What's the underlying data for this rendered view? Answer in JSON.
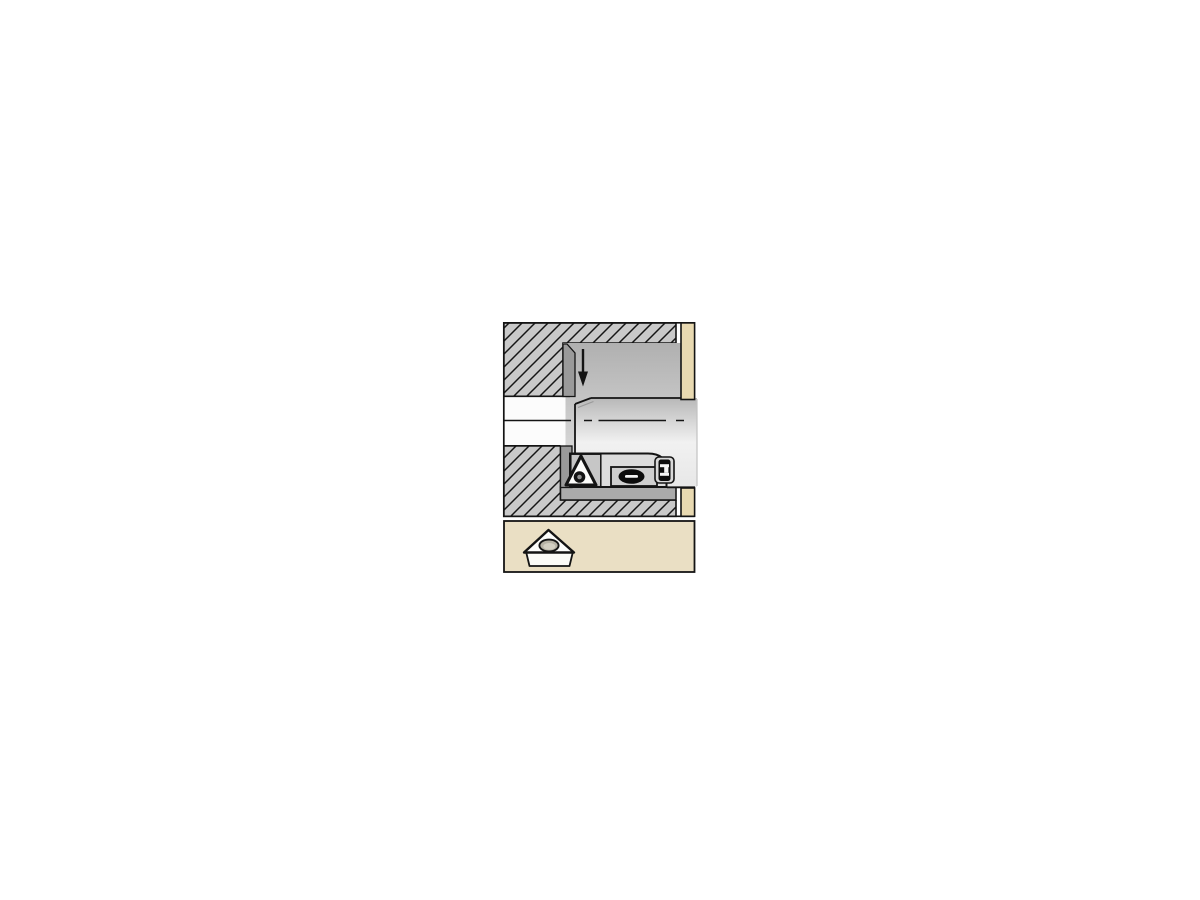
{
  "diagram": {
    "type": "machining-application-illustration",
    "subject": "boring-bar-with-cartridge-cutting-inside-counterbore",
    "icons": {
      "feed_arrow": "downward-feed-direction-arrow",
      "insert_main": "triangular-cutting-insert-with-hole",
      "insert_panel": "triangular-insert-3d-icon",
      "clamp_screw": "slotted-clamp-screw-top-view",
      "adjustment_screw": "side-view-adjustment-screw"
    },
    "colors": {
      "page_bg": "#ffffff",
      "outline": "#141414",
      "hatch_fill": "#c9c9c9",
      "bore_shadow": "#9a9a9a",
      "bore_grad_top": "#b0b0b0",
      "bore_grad_bottom": "#e9e9e9",
      "bar_grad_top": "#b8b8b8",
      "bar_grad_mid": "#f1f1f1",
      "bar_grad_bottom": "#e7e7e7",
      "floor_band": "#ababab",
      "pilot_hole": "#fcfcfc",
      "cartridge_body": "#dcdcdc",
      "cartridge_front": "#c6c6c6",
      "clamp_recess": "#cfcfcf",
      "screw_black": "#0c0c0c",
      "screw_slot_white": "#f4f4f4",
      "insert_face": "#fdfdfb",
      "insert_side": "#fbfbf7",
      "insert_hole_rim": "#b7b3a6",
      "insert_hole_inner": "#d3cfc2",
      "workpiece_face_beige": "#e8d9b1",
      "panel_beige": "#eadfc4"
    }
  }
}
